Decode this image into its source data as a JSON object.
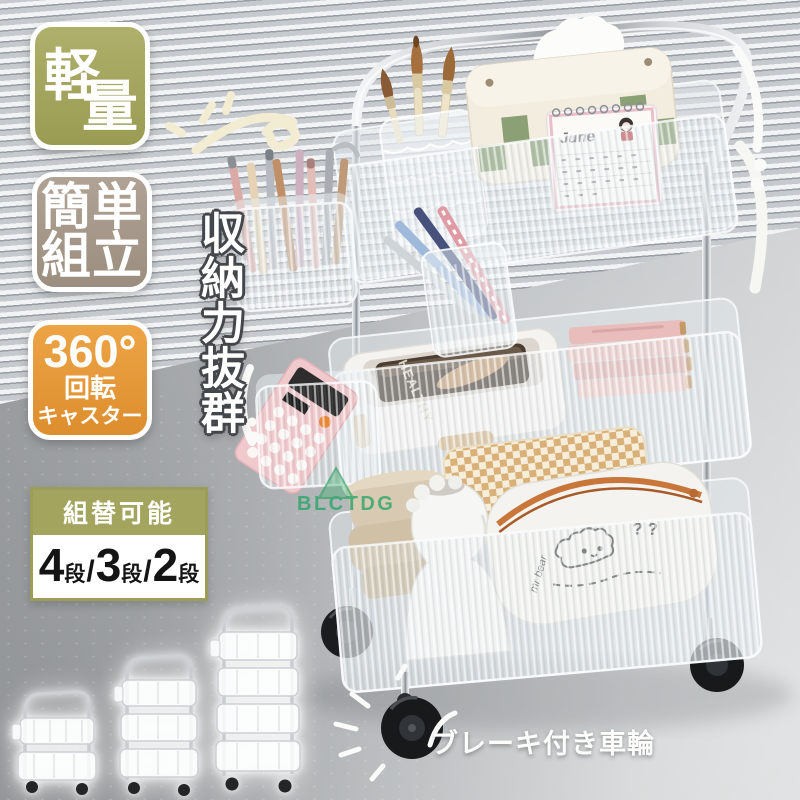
{
  "badges": {
    "lightweight": {
      "char_top": "軽",
      "char_bottom": "量"
    },
    "easy_assembly": {
      "line1": "簡単",
      "line2": "組立"
    },
    "caster": {
      "line1": "360°",
      "line2": "回転",
      "line3": "キャスター"
    }
  },
  "tier_options": {
    "header": "組替可能",
    "separator": "/",
    "options": [
      {
        "count": "4",
        "unit": "段"
      },
      {
        "count": "3",
        "unit": "段"
      },
      {
        "count": "2",
        "unit": "段"
      }
    ]
  },
  "captions": {
    "storage": "収納力抜群",
    "brake_wheels": "ブレーキ付き車輪"
  },
  "watermark": {
    "text": "BLCTDG"
  },
  "cart_items": {
    "lunchbox_label": "HEALTHY",
    "calendar_month": "June",
    "pencil_case_text": "mr bear",
    "pencil_case_marks": "? ?"
  },
  "colors": {
    "badge_olive": "#a5a75f",
    "badge_taupe": "#a89b8c",
    "badge_orange": "#e79a3e",
    "watermark_green": "#2ba56a"
  }
}
